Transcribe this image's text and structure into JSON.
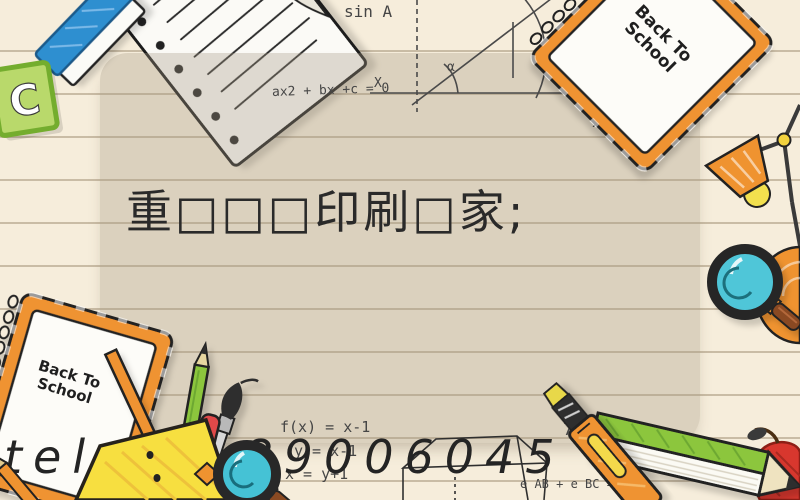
{
  "page": {
    "background_color": "#f6eddb",
    "panel_color": "rgba(164,151,130,0.33)",
    "accent_orange": "#ef9330",
    "accent_teal": "#4fc6d8",
    "accent_green": "#8cc63e",
    "accent_yellow": "#f7df3f",
    "accent_blue": "#2f8fd0",
    "accent_red": "#e04848"
  },
  "title": {
    "text": "重□□□印刷□家;"
  },
  "contact": {
    "tel": "tel:13189006045"
  },
  "notepads": {
    "top_right": {
      "line1": "Back To",
      "line2": "School"
    },
    "bottom_left": {
      "line1": "Back To",
      "line2": "School"
    }
  },
  "card": {
    "letter": "C"
  },
  "formulas": {
    "quadratic": "ax2 + bx +c = 0",
    "sin": "sin A",
    "axis_x": "X",
    "alpha": "α",
    "cubic": "3X2+",
    "fx_top": [
      "f(x) = x-1",
      "y = x-1",
      "x = y+1"
    ],
    "fx_bottom": [
      "f(x) = x-1",
      "y = x-1",
      "x = y+1"
    ],
    "seven_sq": "7²",
    "edge_sum": "e AB + e BC = e AB"
  }
}
